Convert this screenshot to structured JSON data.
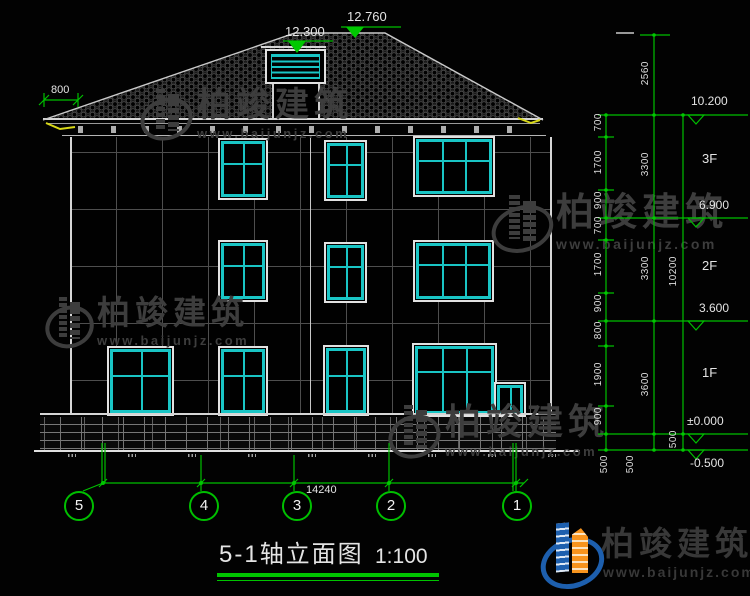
{
  "drawing_title": {
    "name": "5-1轴立面图",
    "scale": "1:100"
  },
  "top_annotations": {
    "eave_overhang": "800",
    "cupola_level": "12.300",
    "ridge_level": "12.760"
  },
  "right_dimensions": {
    "segments_inner": [
      "700",
      "1700",
      "900",
      "700",
      "1700",
      "900",
      "800",
      "1900",
      "900"
    ],
    "segments_middle": [
      "2560",
      "3300",
      "3300",
      "3600"
    ],
    "total": "10200",
    "base_segments": [
      "500",
      "500",
      "500"
    ],
    "levels": [
      "10.200",
      "6.900",
      "3.600",
      "±0.000",
      "-0.500"
    ],
    "floor_labels": [
      "3F",
      "2F",
      "1F"
    ]
  },
  "bottom_annotations": {
    "overall_width": "14240",
    "axis_numbers": [
      "5",
      "4",
      "3",
      "2",
      "1"
    ]
  },
  "watermark": {
    "brand": "柏竣建筑",
    "url": "www.baijunjz.com"
  },
  "colors": {
    "dimension_green": "#00bf00",
    "window_cyan": "#19c5c5",
    "logo_blue": "#1d5fae",
    "logo_orange": "#f7941e"
  }
}
